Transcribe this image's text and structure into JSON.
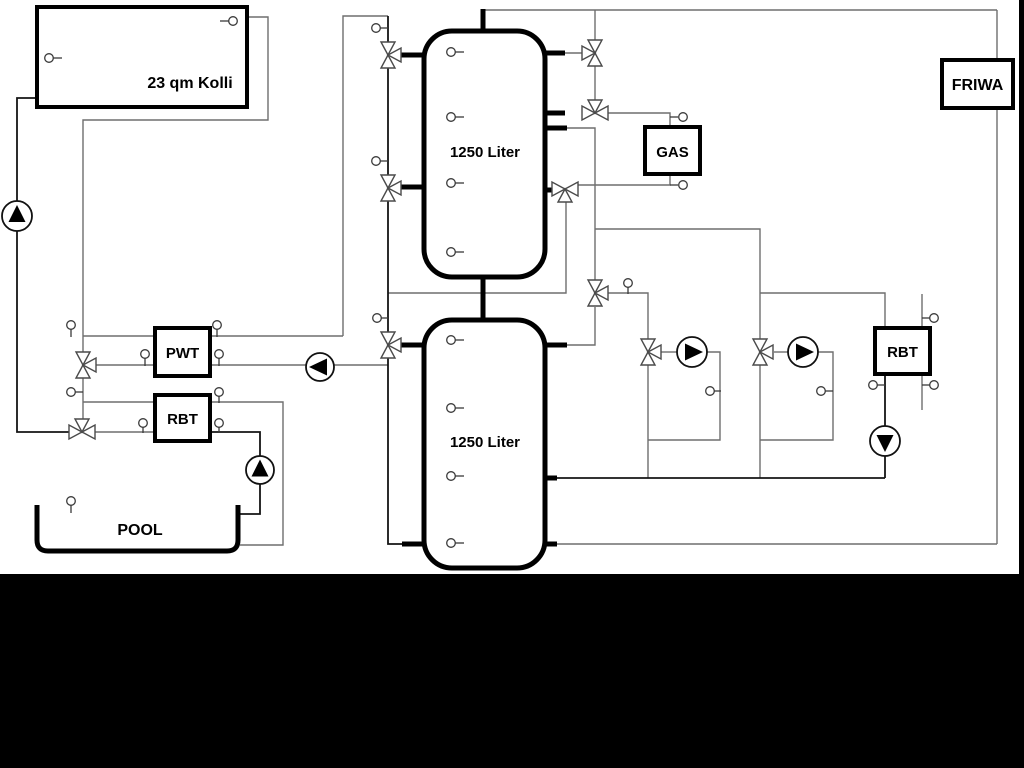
{
  "labels": {
    "collector": "23 qm Kolli",
    "tank_top": "1250 Liter",
    "tank_bottom": "1250 Liter",
    "pwt": "PWT",
    "rbt_left": "RBT",
    "rbt_right": "RBT",
    "gas": "GAS",
    "friwa": "FRIWA",
    "pool": "POOL"
  },
  "colors": {
    "canvas": "#ffffff",
    "pipe_gray": "#6e6e6e",
    "pipe_dark": "#141414",
    "outline": "#000000",
    "letterbox": "#000000"
  }
}
